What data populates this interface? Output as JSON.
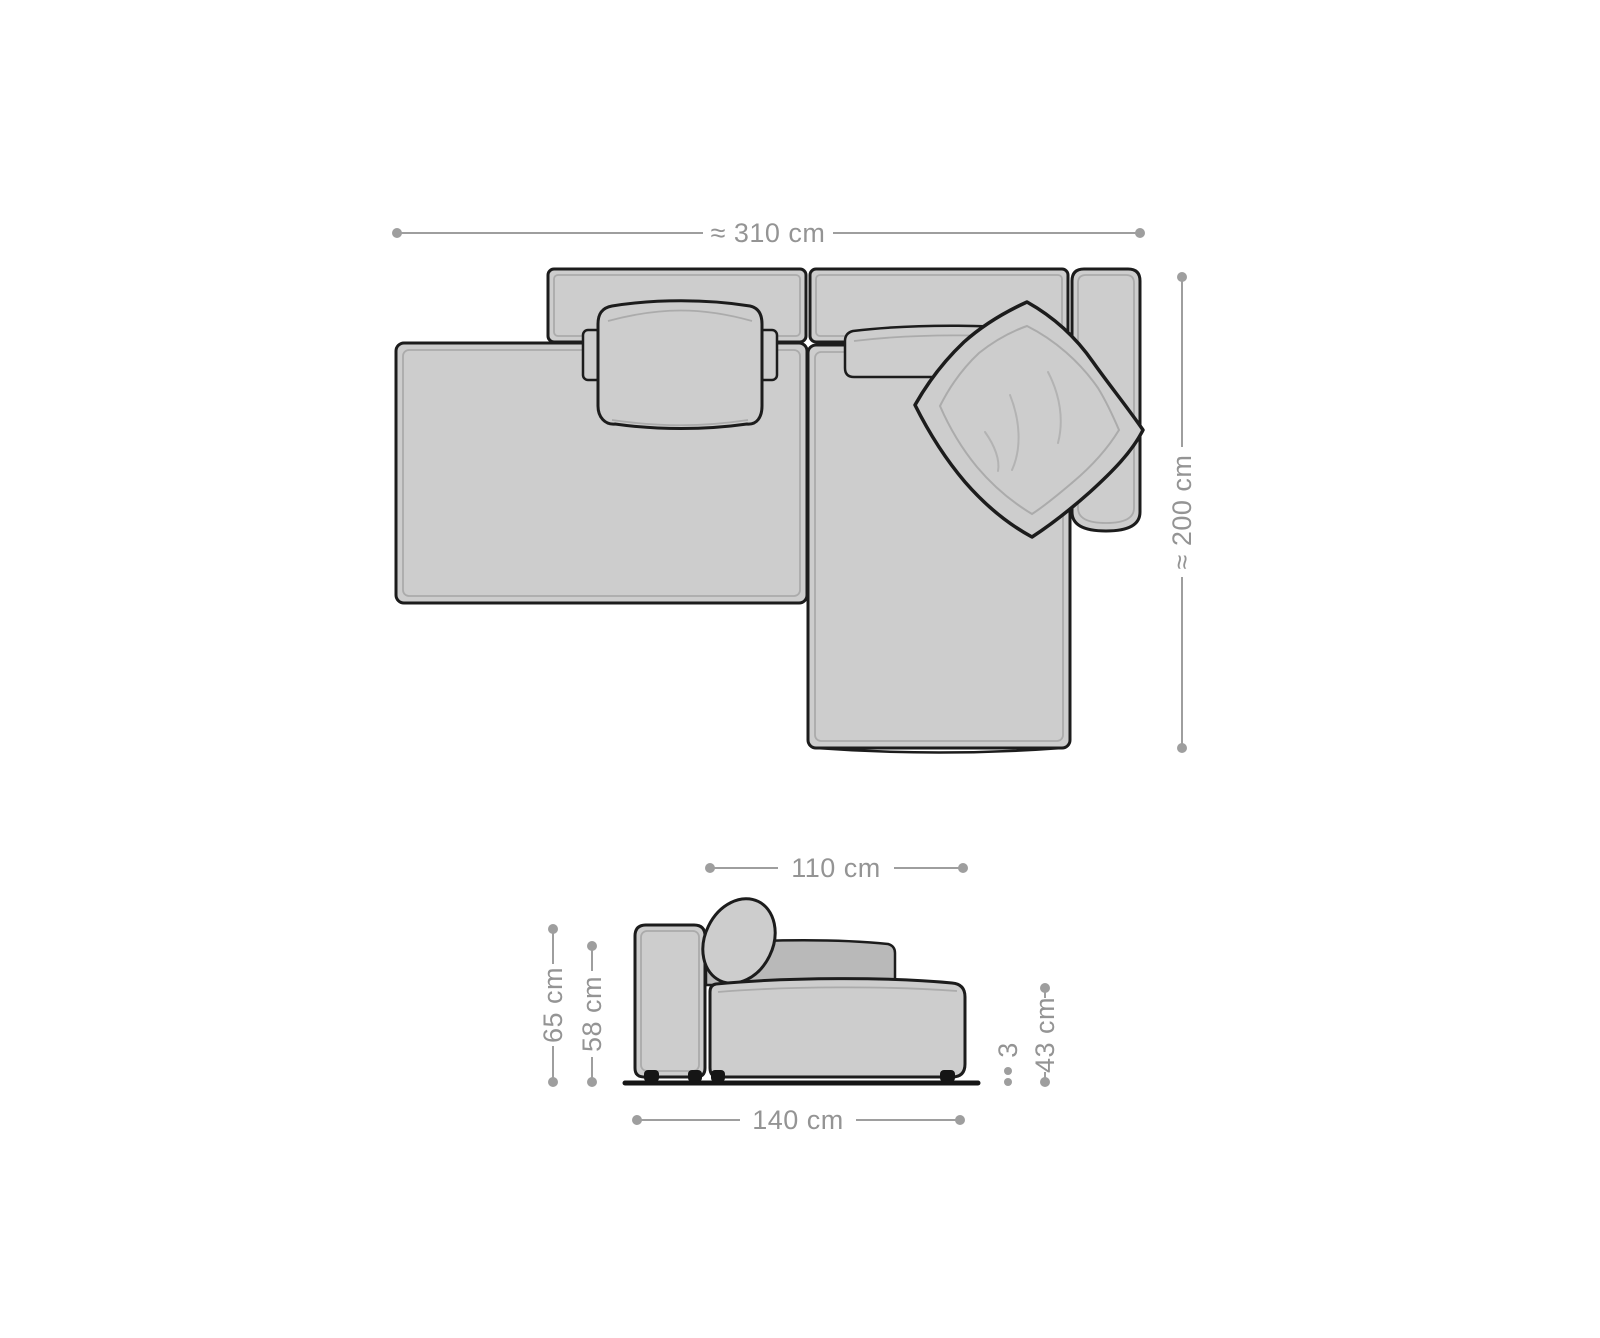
{
  "colors": {
    "background": "#ffffff",
    "upholstery_fill": "#cdcdcd",
    "backrest_fill": "#b9b9b9",
    "outline": "#1c1c1c",
    "seam_line": "#a5a5a5",
    "dimension_line": "#9e9e9e",
    "dimension_text": "#949494",
    "feet": "#151515"
  },
  "top_view": {
    "dimensions": {
      "width_label": "≈ 310 cm",
      "depth_label": "≈ 200 cm"
    }
  },
  "side_view": {
    "dimensions": {
      "top_width_label": "110 cm",
      "outer_height_label": "65 cm",
      "inner_height_label": "58 cm",
      "seat_height_label": "43 cm",
      "foot_height_label": "3",
      "bottom_width_label": "140 cm"
    }
  }
}
